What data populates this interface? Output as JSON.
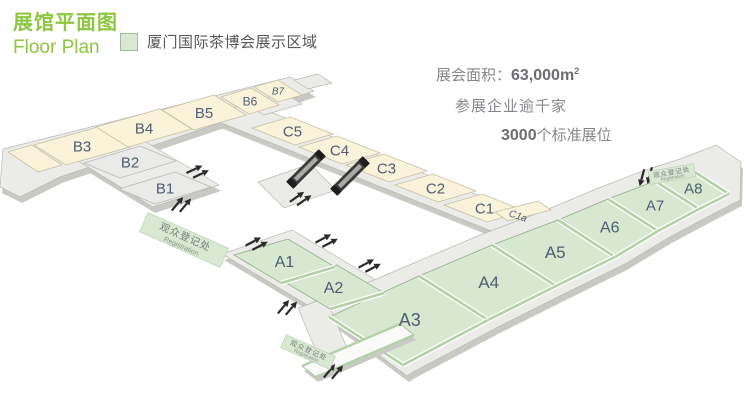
{
  "header": {
    "title_cn": "展馆平面图",
    "title_en": "Floor Plan"
  },
  "legend": {
    "label": "厦门国际茶博会展示区域",
    "swatch_color": "#d9e8d3"
  },
  "stats": {
    "area_label": "展会面积：",
    "area_value": "63,000m",
    "area_sup": "2",
    "companies": "参展企业逾千家",
    "booths_value": "3000",
    "booths_label": "个标准展位"
  },
  "badge_text": {
    "cn": "观众登记处",
    "en": "Registration"
  },
  "floorplan": {
    "colors": {
      "accent_green": "#8dc63f",
      "hall_cream": "#faf3da",
      "hall_green": "#d7e8d0",
      "hall_gray": "#eaebe9",
      "base_gray": "#ebebe7",
      "base_shadow": "#c9c9c4",
      "cream_stroke": "#c5bfa2",
      "green_stroke": "#8fae89",
      "green_band": "#b3d1a7",
      "gray_stroke": "#b9b9b3",
      "label_color": "#4e5d70",
      "escalator_dark": "#3a3a3a",
      "escalator_light": "#a8a8a4",
      "arrow_color": "#2b2b2b",
      "badge_fill": "#d8e9d1",
      "badge_stroke": "#b7cfae",
      "badge_text_color": "#787878",
      "walkway_white": "#fafaf8"
    },
    "labels": {
      "b1": "B1",
      "b2": "B2",
      "b3": "B3",
      "b4": "B4",
      "b5": "B5",
      "b6": "B6",
      "b7": "B7",
      "c1": "C1",
      "c2": "C2",
      "c3": "C3",
      "c4": "C4",
      "c5": "C5",
      "c1a": "C1a",
      "a1": "A1",
      "a2": "A2",
      "a3": "A3",
      "a4": "A4",
      "a5": "A5",
      "a6": "A6",
      "a7": "A7",
      "a8": "A8"
    },
    "wings": [
      {
        "id": "b-row",
        "hall_type": "cream",
        "base": [
          [
            3,
            149
          ],
          [
            290,
            77
          ],
          [
            314,
            91
          ],
          [
            60,
            177
          ],
          [
            20,
            197
          ],
          [
            0,
            187
          ]
        ],
        "halls": [
          {
            "id": "b-annex",
            "label_key": null,
            "points": [
              [
                8,
                152
              ],
              [
                32,
                145
              ],
              [
                62,
                165
              ],
              [
                38,
                172
              ]
            ]
          },
          {
            "id": "b3",
            "label_key": "b3",
            "points": [
              [
                34,
                145
              ],
              [
                98,
                127
              ],
              [
                130,
                147
              ],
              [
                66,
                165
              ]
            ],
            "font": 15
          },
          {
            "id": "b4",
            "label_key": "b4",
            "points": [
              [
                96,
                127
              ],
              [
                160,
                109
              ],
              [
                192,
                129
              ],
              [
                128,
                147
              ]
            ],
            "font": 15
          },
          {
            "id": "b5",
            "label_key": "b5",
            "points": [
              [
                162,
                110
              ],
              [
                214,
                95
              ],
              [
                246,
                115
              ],
              [
                194,
                130
              ]
            ],
            "font": 15
          },
          {
            "id": "b6",
            "label_key": "b6",
            "points": [
              [
                221,
                97
              ],
              [
                251,
                88
              ],
              [
                279,
                105
              ],
              [
                249,
                114
              ]
            ],
            "font": 12
          },
          {
            "id": "b7",
            "label_key": "b7",
            "points": [
              [
                254,
                87
              ],
              [
                278,
                80
              ],
              [
                302,
                95
              ],
              [
                278,
                102
              ]
            ],
            "font": 10,
            "italic": true
          }
        ]
      },
      {
        "id": "b12",
        "hall_type": "graycell",
        "base": [
          [
            78,
            161
          ],
          [
            144,
            141
          ],
          [
            219,
            185
          ],
          [
            153,
            207
          ]
        ],
        "halls": [
          {
            "id": "b2",
            "label_key": "b2",
            "points": [
              [
                84,
                163
              ],
              [
                140,
                146
              ],
              [
                176,
                161
              ],
              [
                120,
                178
              ]
            ],
            "font": 15
          },
          {
            "id": "b1",
            "label_key": "b1",
            "points": [
              [
                119,
                189
              ],
              [
                175,
                172
              ],
              [
                211,
                187
              ],
              [
                155,
                204
              ]
            ],
            "font": 15
          }
        ]
      },
      {
        "id": "c-row",
        "hall_type": "cream",
        "base": [
          [
            248,
            103
          ],
          [
            540,
            220
          ],
          [
            496,
            233
          ],
          [
            204,
            116
          ]
        ],
        "halls": [
          {
            "id": "c5",
            "label_key": "c5",
            "points": [
              [
                252,
                128
              ],
              [
                290,
                117
              ],
              [
                333,
                134
              ],
              [
                295,
                145
              ]
            ],
            "font": 15
          },
          {
            "id": "c4",
            "label_key": "c4",
            "points": [
              [
                299,
                147
              ],
              [
                337,
                136
              ],
              [
                380,
                153
              ],
              [
                342,
                164
              ]
            ],
            "font": 15
          },
          {
            "id": "c3",
            "label_key": "c3",
            "points": [
              [
                346,
                165
              ],
              [
                384,
                154
              ],
              [
                427,
                171
              ],
              [
                389,
                182
              ]
            ],
            "font": 15
          },
          {
            "id": "c2",
            "label_key": "c2",
            "points": [
              [
                395,
                185
              ],
              [
                433,
                174
              ],
              [
                476,
                191
              ],
              [
                438,
                202
              ]
            ],
            "font": 15
          },
          {
            "id": "c1",
            "label_key": "c1",
            "points": [
              [
                444,
                205
              ],
              [
                482,
                194
              ],
              [
                525,
                211
              ],
              [
                487,
                222
              ]
            ],
            "font": 15
          },
          {
            "id": "c1a-strip",
            "label_key": null,
            "points": [
              [
                495,
                212
              ],
              [
                538,
                201
              ],
              [
                551,
                210
              ],
              [
                508,
                221
              ]
            ]
          }
        ]
      },
      {
        "id": "a12",
        "hall_type": "green",
        "base": [
          [
            222,
            254
          ],
          [
            292,
            230
          ],
          [
            396,
            292
          ],
          [
            326,
            316
          ]
        ],
        "halls": [
          {
            "id": "a1",
            "label_key": "a1",
            "points": [
              [
                234,
                255
              ],
              [
                288,
                239
              ],
              [
                335,
                267
              ],
              [
                281,
                283
              ]
            ],
            "font": 16
          },
          {
            "id": "a2",
            "label_key": "a2",
            "points": [
              [
                283,
                281
              ],
              [
                337,
                265
              ],
              [
                384,
                293
              ],
              [
                330,
                309
              ]
            ],
            "font": 16
          }
        ]
      },
      {
        "id": "a-row",
        "hall_type": "green",
        "base": [
          [
            313,
            306
          ],
          [
            407,
            266
          ],
          [
            480,
            235
          ],
          [
            546,
            210
          ],
          [
            596,
            189
          ],
          [
            643,
            171
          ],
          [
            680,
            159
          ],
          [
            716,
            145
          ],
          [
            741,
            162
          ],
          [
            740,
            200
          ],
          [
            709,
            216
          ],
          [
            668,
            238
          ],
          [
            625,
            264
          ],
          [
            566,
            293
          ],
          [
            498,
            327
          ],
          [
            413,
            372
          ],
          [
            407,
            376
          ]
        ],
        "halls": [
          {
            "id": "a3",
            "label_key": "a3",
            "points": [
              [
                329,
                317
              ],
              [
                419,
                276
              ],
              [
                488,
                320
              ],
              [
                403,
                365
              ]
            ],
            "font": 18
          },
          {
            "id": "a4",
            "label_key": "a4",
            "points": [
              [
                419,
                276
              ],
              [
                492,
                245
              ],
              [
                556,
                286
              ],
              [
                488,
                320
              ]
            ],
            "font": 17
          },
          {
            "id": "a5",
            "label_key": "a5",
            "points": [
              [
                492,
                245
              ],
              [
                558,
                220
              ],
              [
                615,
                257
              ],
              [
                556,
                286
              ]
            ],
            "font": 17
          },
          {
            "id": "a6",
            "label_key": "a6",
            "points": [
              [
                558,
                220
              ],
              [
                608,
                199
              ],
              [
                658,
                231
              ],
              [
                615,
                257
              ]
            ],
            "font": 16
          },
          {
            "id": "a7",
            "label_key": "a7",
            "points": [
              [
                608,
                199
              ],
              [
                655,
                181
              ],
              [
                699,
                209
              ],
              [
                658,
                231
              ]
            ],
            "font": 15
          },
          {
            "id": "a8",
            "label_key": "a8",
            "points": [
              [
                655,
                181
              ],
              [
                690,
                169
              ],
              [
                729,
                194
              ],
              [
                699,
                209
              ]
            ],
            "font": 15
          }
        ]
      }
    ],
    "band_lines": [
      [
        [
          329,
          317
        ],
        [
          403,
          365
        ]
      ],
      [
        [
          419,
          276
        ],
        [
          488,
          320
        ]
      ],
      [
        [
          492,
          245
        ],
        [
          556,
          286
        ]
      ],
      [
        [
          558,
          220
        ],
        [
          615,
          257
        ]
      ],
      [
        [
          608,
          199
        ],
        [
          658,
          231
        ]
      ],
      [
        [
          655,
          181
        ],
        [
          699,
          209
        ]
      ],
      [
        [
          690,
          169
        ],
        [
          729,
          194
        ]
      ],
      [
        [
          403,
          365
        ],
        [
          488,
          320
        ]
      ],
      [
        [
          488,
          320
        ],
        [
          556,
          286
        ]
      ],
      [
        [
          556,
          286
        ],
        [
          615,
          257
        ]
      ],
      [
        [
          615,
          257
        ],
        [
          658,
          231
        ]
      ],
      [
        [
          658,
          231
        ],
        [
          699,
          209
        ]
      ],
      [
        [
          699,
          209
        ],
        [
          729,
          194
        ]
      ],
      [
        [
          281,
          283
        ],
        [
          335,
          267
        ]
      ],
      [
        [
          330,
          309
        ],
        [
          384,
          293
        ]
      ]
    ],
    "connectors": [
      [
        [
          246,
          104
        ],
        [
          284,
          93
        ],
        [
          302,
          104
        ],
        [
          264,
          115
        ]
      ],
      [
        [
          294,
          80
        ],
        [
          318,
          74
        ],
        [
          332,
          83
        ],
        [
          308,
          89
        ]
      ],
      [
        [
          298,
          308
        ],
        [
          326,
          298
        ],
        [
          352,
          360
        ],
        [
          324,
          370
        ]
      ]
    ],
    "landing": [
      [
        258,
        182
      ],
      [
        310,
        164
      ],
      [
        336,
        190
      ],
      [
        284,
        208
      ]
    ],
    "walkway": [
      [
        302,
        366
      ],
      [
        400,
        324
      ],
      [
        414,
        335
      ],
      [
        316,
        377
      ]
    ],
    "escalators": [
      {
        "cx": 306,
        "cy": 169,
        "angle": -45
      },
      {
        "cx": 350,
        "cy": 176,
        "angle": -45
      }
    ],
    "arrows": [
      {
        "x": 197,
        "y": 172,
        "angle": -25
      },
      {
        "x": 181,
        "y": 205,
        "angle": -50
      },
      {
        "x": 256,
        "y": 244,
        "angle": -28
      },
      {
        "x": 326,
        "y": 241,
        "angle": -28
      },
      {
        "x": 369,
        "y": 266,
        "angle": -28
      },
      {
        "x": 287,
        "y": 308,
        "angle": -50
      },
      {
        "x": 333,
        "y": 372,
        "angle": -50
      },
      {
        "x": 300,
        "y": 199,
        "angle": -35
      },
      {
        "x": 646,
        "y": 176,
        "angle": 105
      }
    ],
    "badges": [
      {
        "cx": 184,
        "cy": 240,
        "w": 88,
        "h": 21,
        "angle": 24,
        "cn_size": 10,
        "en_size": 7
      },
      {
        "cx": 308,
        "cy": 352,
        "w": 54,
        "h": 14,
        "angle": 24,
        "cn_size": 7,
        "en_size": 5
      },
      {
        "cx": 672,
        "cy": 174,
        "w": 46,
        "h": 13,
        "angle": -10,
        "cn_size": 6.5,
        "en_size": 4.5
      }
    ],
    "extra_labels": [
      {
        "key": "c1a",
        "x": 517,
        "y": 219,
        "angle": 18,
        "size": 10,
        "italic": true
      }
    ]
  }
}
